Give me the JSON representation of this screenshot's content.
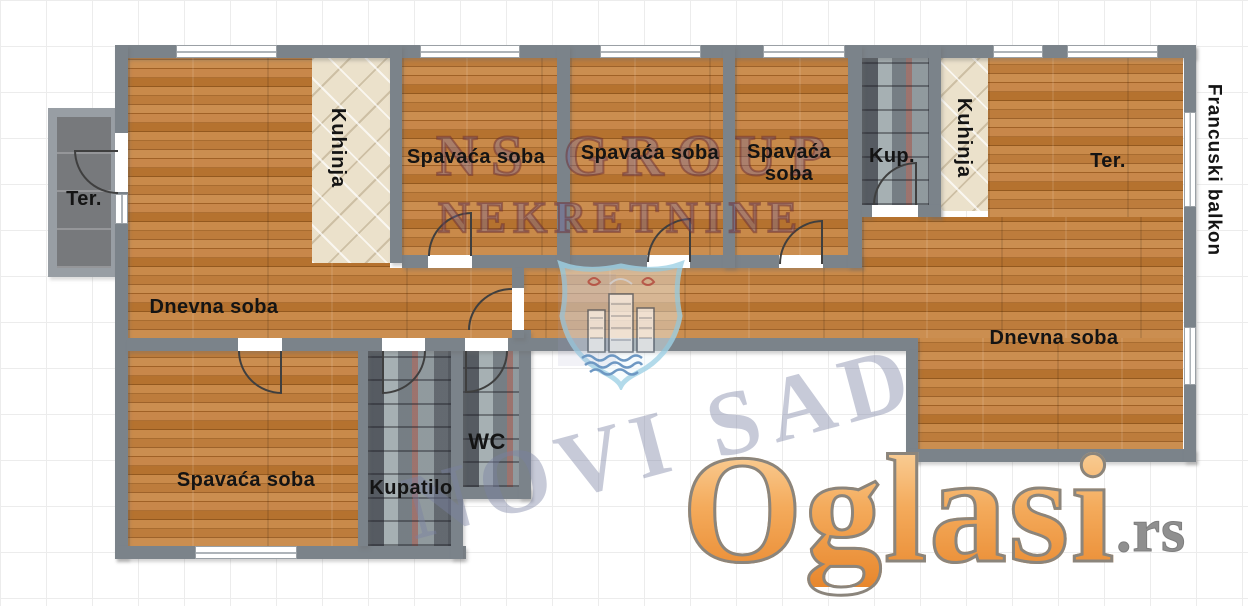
{
  "rooms": {
    "terrace_left": "Ter.",
    "kitchen_left": "Kuhinja",
    "bedroom_1": "Spavaća soba",
    "bedroom_2": "Spavaća soba",
    "bedroom_3": "Spavaća soba",
    "bathroom_small": "Kup.",
    "kitchen_right": "Kuhinja",
    "terrace_right": "Ter.",
    "french_balcony": "Francuski balkon",
    "living_left": "Dnevna soba",
    "living_right": "Dnevna soba",
    "bedroom_4": "Spavaća soba",
    "bathroom": "Kupatilo",
    "wc": "WC"
  },
  "watermarks": {
    "agency_line1": "NS GROUP",
    "agency_line2": "NEKRETNINE",
    "city": "NOVI SAD",
    "portal": "Oglasi",
    "portal_tld": ".rs"
  },
  "colors": {
    "wall_gray": "#7b838a",
    "wood": "#c08040",
    "kitchen_tile": "#ebe1cb",
    "bath_tile": "#8d979c",
    "terrace_gray": "#77797c",
    "portal_orange": "#f0a050",
    "watermark_maroon": "#6e2d2d",
    "watermark_blue_gray": "#7a80a2",
    "shield_light_blue": "#a6d9ec"
  }
}
